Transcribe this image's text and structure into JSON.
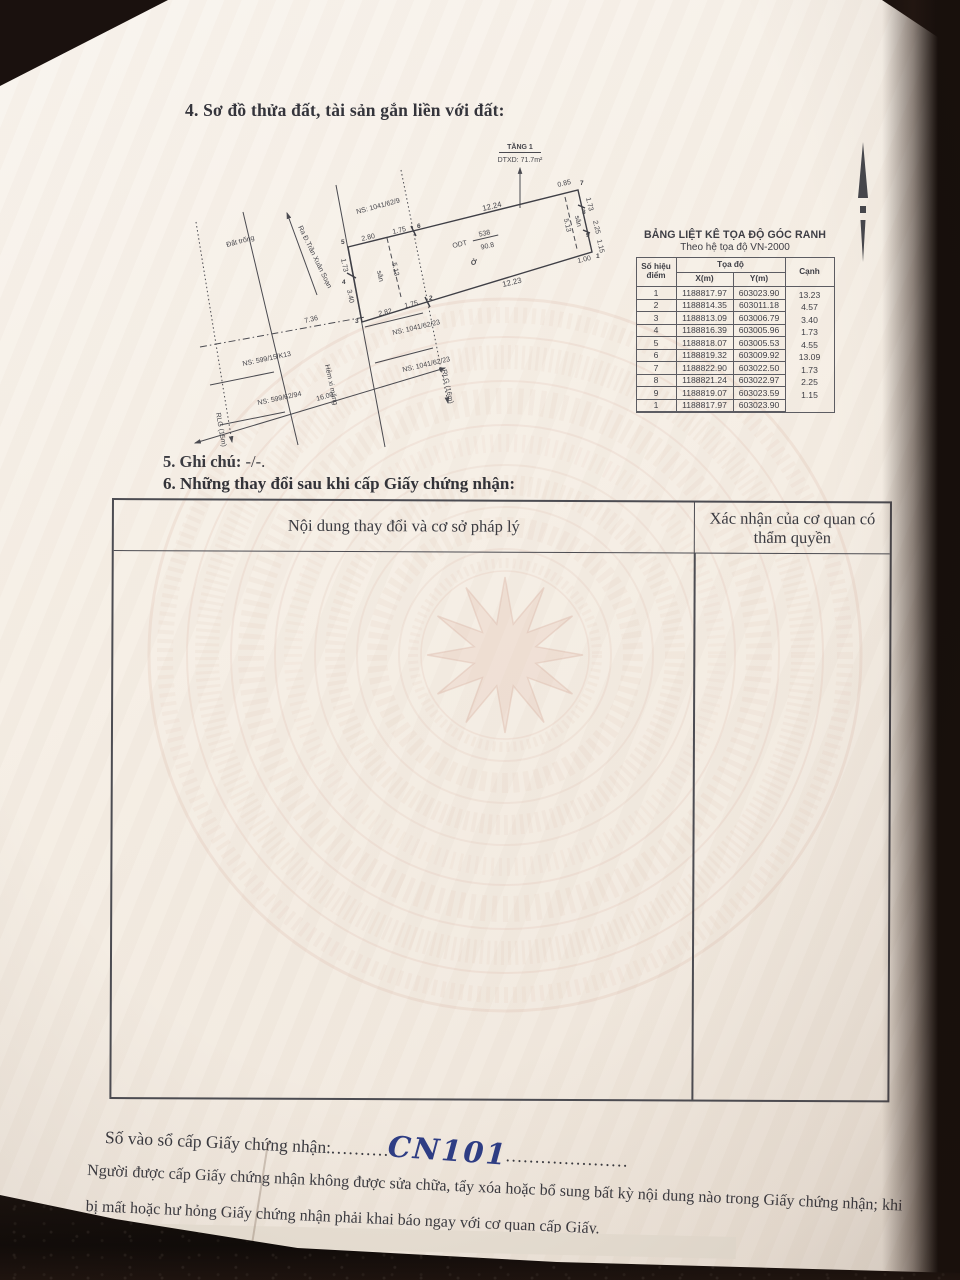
{
  "document": {
    "section4": {
      "title": "4. Sơ đồ thửa đất, tài sản gắn liền với đất:"
    },
    "section5": {
      "label": "5. Ghi chú:",
      "value": "-/-."
    },
    "section6": {
      "title": "6. Những thay đổi sau khi cấp Giấy chứng nhận:",
      "table": {
        "col1": "Nội dung thay đổi và cơ sở pháp lý",
        "col2": "Xác nhận của cơ quan có thẩm quyền"
      }
    },
    "registry": {
      "label": "Số vào sổ cấp Giấy chứng nhận:",
      "dots_left": "..........",
      "value": "CN101",
      "dots_right": "....................."
    },
    "footer_note": "Người được cấp Giấy chứng nhận không được sửa chữa, tẩy xóa hoặc bổ sung bất kỳ nội dung nào trong Giấy chứng nhận; khi bị mất hoặc hư hỏng Giấy chứng nhận phải khai báo ngay với cơ quan cấp Giấy."
  },
  "diagram": {
    "floor": {
      "label": "TẦNG 1",
      "area": "DTXD: 71.7m²"
    },
    "parcel": {
      "type": "ODT",
      "number": "538",
      "area": "90.8",
      "use": "Ở"
    },
    "dims": {
      "d1224": "12.24",
      "d1223": "12.23",
      "d280": "2.80",
      "d175": "1.75",
      "d282": "2.82",
      "d173": "1.73",
      "d340": "3.40",
      "d513": "5.13",
      "d085": "0.85",
      "d225": "2.25",
      "d115": "1.15",
      "d100": "1.00",
      "d736": "7.36",
      "d1600": "16.00"
    },
    "texts": {
      "san": "sân",
      "dat_trong": "Đất trống",
      "hem": "Hẻm xi măng",
      "street": "Ra Đ.Trần Xuân Soạn",
      "rlg15": "RLG (15m)",
      "rlg16": "RLG (16m)",
      "ns1": "NS: 1041/62/9",
      "ns2": "NS: 1041/62/23",
      "ns3": "NS: 599/15/K13",
      "ns4": "NS: 599/62/94"
    },
    "points": {
      "p1": "1",
      "p2": "2",
      "p3": "3",
      "p4": "4",
      "p5": "5",
      "p6": "6",
      "p7": "7",
      "p8": "8",
      "p9": "9"
    }
  },
  "coord_table": {
    "title": "BẢNG LIỆT KÊ TỌA ĐỘ GÓC RANH",
    "subtitle": "Theo hệ tọa độ VN-2000",
    "headers": {
      "point": "Số hiệu điểm",
      "coord": "Tọa độ",
      "x": "X(m)",
      "y": "Y(m)",
      "edge": "Cạnh"
    },
    "rows": [
      {
        "p": "1",
        "x": "1188817.97",
        "y": "603023.90"
      },
      {
        "p": "2",
        "x": "1188814.35",
        "y": "603011.18"
      },
      {
        "p": "3",
        "x": "1188813.09",
        "y": "603006.79"
      },
      {
        "p": "4",
        "x": "1188816.39",
        "y": "603005.96"
      },
      {
        "p": "5",
        "x": "1188818.07",
        "y": "603005.53"
      },
      {
        "p": "6",
        "x": "1188819.32",
        "y": "603009.92"
      },
      {
        "p": "7",
        "x": "1188822.90",
        "y": "603022.50"
      },
      {
        "p": "8",
        "x": "1188821.24",
        "y": "603022.97"
      },
      {
        "p": "9",
        "x": "1188819.07",
        "y": "603023.59"
      },
      {
        "p": "1",
        "x": "1188817.97",
        "y": "603023.90"
      }
    ],
    "edges": [
      "13.23",
      "4.57",
      "3.40",
      "1.73",
      "4.55",
      "13.09",
      "1.73",
      "2.25",
      "1.15"
    ]
  },
  "colors": {
    "ink": "#3a3a40",
    "handwriting": "#2e3d85",
    "watermark": "#d9a796"
  }
}
